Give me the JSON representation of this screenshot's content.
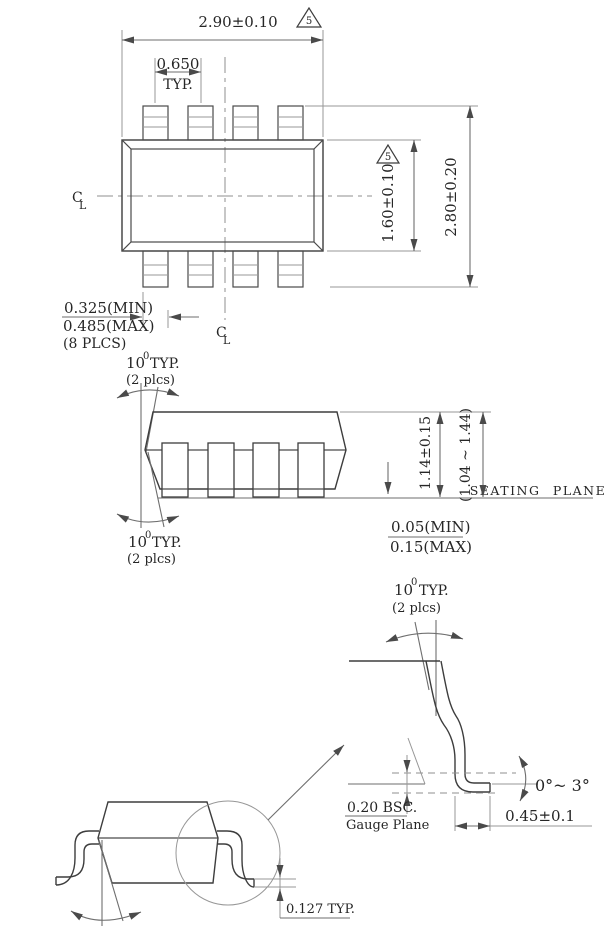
{
  "symbols": {
    "centerline_c": "C",
    "centerline_l": "L",
    "flag_number": "5"
  },
  "top_view": {
    "dim_width": "2.90±0.10",
    "dim_pitch": "0.650",
    "dim_pitch_suffix": "TYP.",
    "dim_body_depth": "1.60±0.10",
    "dim_overall_depth": "2.80±0.20",
    "lead_width_min": "0.325(MIN)",
    "lead_width_max": "0.485(MAX)",
    "lead_width_note": "(8 PLCS)"
  },
  "side_view": {
    "lead_angle_value": "10",
    "lead_angle_sup": "0",
    "lead_angle_suffix": "TYP.",
    "lead_angle_places": "(2 plcs)",
    "dim_height": "1.14±0.15",
    "dim_height_range": "(1.04 ~ 1.44)",
    "seating_plane_label": "SEATING PLANE",
    "standoff_min": "0.05(MIN)",
    "standoff_max": "0.15(MAX)"
  },
  "detail_view": {
    "lead_angle_value": "10",
    "lead_angle_sup": "0",
    "lead_angle_suffix": "TYP.",
    "lead_angle_places": "(2 plcs)",
    "foot_angle_range": "0°~ 3°",
    "gauge_offset": "0.20 BSC.",
    "gauge_plane_label": "Gauge Plane",
    "foot_length": "0.45±0.1",
    "lead_thickness": "0.127 TYP."
  }
}
